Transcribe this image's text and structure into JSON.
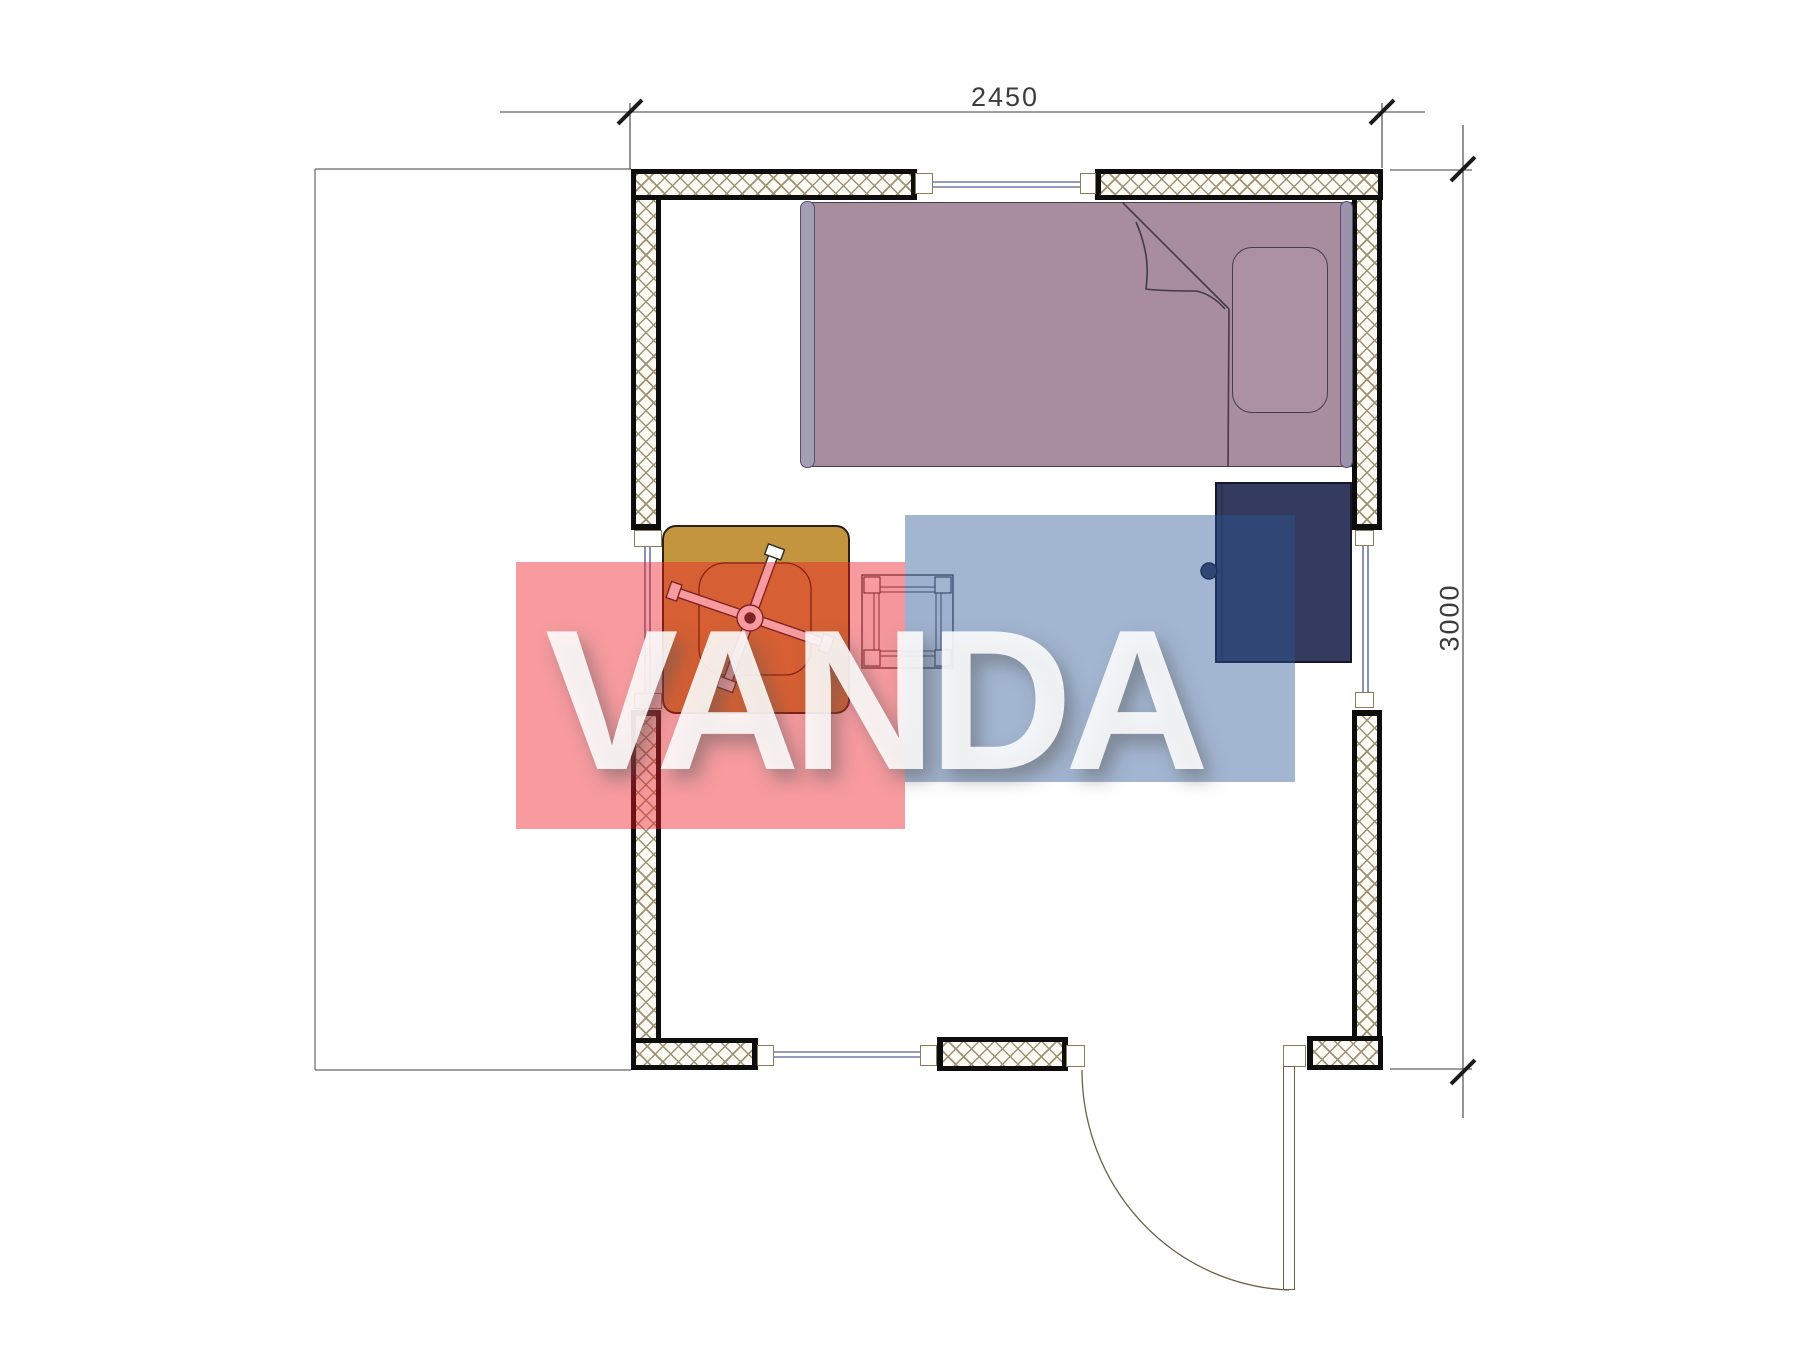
{
  "drawing": {
    "type": "architectural floor plan of a small cabin room",
    "watermark_text": "VANDA",
    "dimensions": {
      "width_label": "2450",
      "height_label": "3000"
    },
    "furniture": [
      "single-bed",
      "pillow",
      "folded-blanket",
      "wardrobe",
      "square-table",
      "ceiling-fan-symbol",
      "stool"
    ],
    "openings": {
      "windows": 4,
      "doors": 1
    },
    "colors": {
      "wall_hatch": "#9c9277",
      "wall_edge": "#0d0d0d",
      "bed_fill": "#a78d9e",
      "bed_rail": "#a39eb4",
      "table_fill": "#c4953f",
      "wardrobe_fill": "#343b5e",
      "window_glass": "#2a3580",
      "dimension_line": "#3c3c3c",
      "watermark_red": "#ed1c24",
      "watermark_blue": "#2b5797"
    }
  }
}
